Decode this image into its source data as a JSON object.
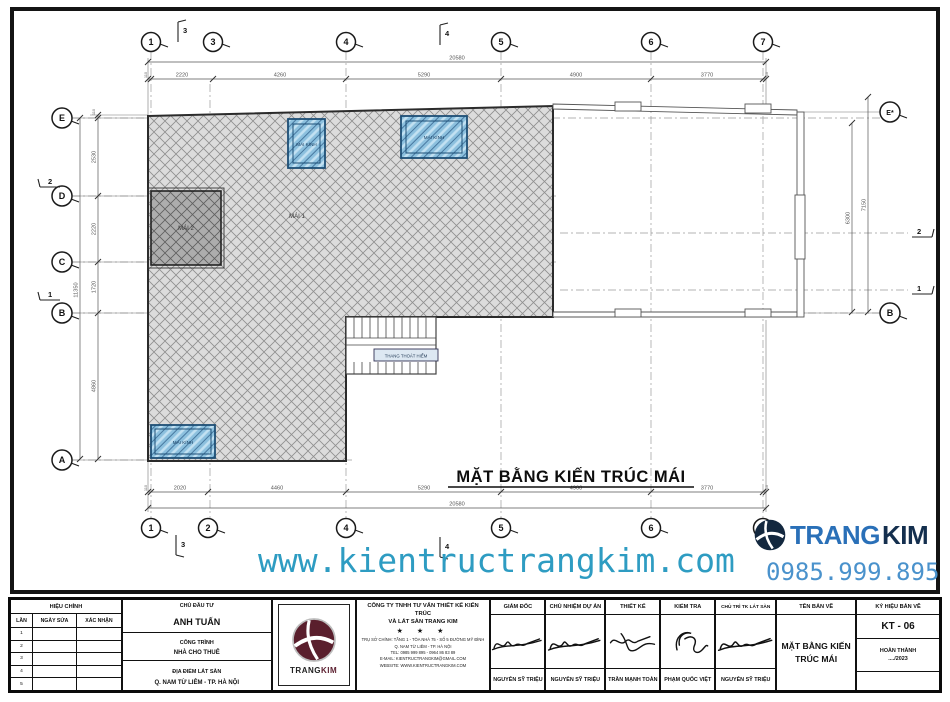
{
  "plan": {
    "title": "MẶT BẰNG KIẾN TRÚC MÁI",
    "labels": {
      "mai1": "MÁI 1",
      "mai2": "MÁI 2",
      "skylight": "MÁI KÍNH",
      "stair": "THANG THOÁT HIỂM"
    },
    "grid": {
      "top": [
        "1",
        "3",
        "4",
        "5",
        "6",
        "7"
      ],
      "bottom": [
        "1",
        "2",
        "4",
        "5",
        "6",
        "7"
      ],
      "left": [
        "E",
        "D",
        "C",
        "B",
        "A"
      ],
      "right": [
        "E*",
        "B"
      ]
    },
    "sections": {
      "top": [
        "3",
        "4"
      ],
      "bottom": [
        "3",
        "4"
      ],
      "left": [
        "2",
        "1"
      ],
      "right": [
        "2",
        "1"
      ]
    },
    "dims": {
      "top": {
        "total": "20580",
        "segs": [
          "110",
          "2220",
          "4260",
          "5290",
          "4900",
          "3770",
          "110"
        ]
      },
      "bottom": {
        "total": "20580",
        "segs": [
          "110",
          "2020",
          "4460",
          "5290",
          "4900",
          "3770",
          "110"
        ]
      },
      "left": {
        "total": "11350",
        "segs": [
          "110",
          "2530",
          "2220",
          "1720",
          "4860"
        ]
      },
      "right": [
        "6300",
        "7150"
      ]
    }
  },
  "watermark": {
    "url": "www.kientructrangkim.com",
    "phone": "0985.999.895",
    "brand_trang": "TRANG",
    "brand_kim": "KIM"
  },
  "titleblock": {
    "revision": {
      "title": "HIỆU CHỈNH",
      "col_lan": "LẦN",
      "col_ngay": "NGÀY SỬA",
      "col_xacnhan": "XÁC NHẬN",
      "rows": [
        "1",
        "2",
        "3",
        "4",
        "5"
      ]
    },
    "project": {
      "investor_label": "CHỦ ĐẦU TƯ",
      "investor": "ANH TUẤN",
      "work_label": "CÔNG TRÌNH",
      "work": "NHÀ CHO THUÊ",
      "location_label": "ĐỊA ĐIỂM LÁT SÀN",
      "location": "Q. NAM TỪ LIÊM - TP. HÀ NỘI"
    },
    "company": {
      "logo_trang": "TRANG",
      "logo_kim": "KIM",
      "name1": "CÔNG TY TNHH TƯ VẤN THIẾT KẾ KIẾN TRÚC",
      "name2": "VÀ LÁT SÀN TRANG KIM",
      "stars": "★ ★ ★",
      "addr1": "TRỤ SỞ CHÍNH: TẦNG 1 - TÒA NHÀ 75 - SỐ 5 ĐƯỜNG MỸ ĐÌNH",
      "addr2": "Q. NAM TỪ LIÊM - TP. HÀ NỘI",
      "tel": "TEL: 0985 999 895 - 0964 86 83 89",
      "email": "E-MAIL: KIENTRUCTRANGKIM@GMAIL.COM",
      "website": "WEBSITE: WWW.KIENTRUCTRANGKIM.COM"
    },
    "signatures": [
      {
        "title": "GIÁM ĐỐC",
        "name": "NGUYỄN SỸ TRIỆU"
      },
      {
        "title": "CHỦ NHIỆM DỰ ÁN",
        "name": "NGUYỄN SỸ TRIỆU"
      },
      {
        "title": "THIẾT KẾ",
        "name": "TRẦN MẠNH TOÀN"
      },
      {
        "title": "KIỂM TRA",
        "name": "PHẠM QUỐC VIỆT"
      },
      {
        "title": "CHỦ TRÌ TK LÁT SÀN",
        "name": "NGUYỄN SỸ TRIỆU"
      }
    ],
    "drawing": {
      "name_label": "TÊN BẢN VẼ",
      "name": "MẶT BẰNG KIẾN TRÚC MÁI",
      "code_label": "KÝ HIỆU BẢN VẼ",
      "code": "KT - 06",
      "status": "HOÀN THÀNH",
      "date": "..../2023"
    }
  }
}
